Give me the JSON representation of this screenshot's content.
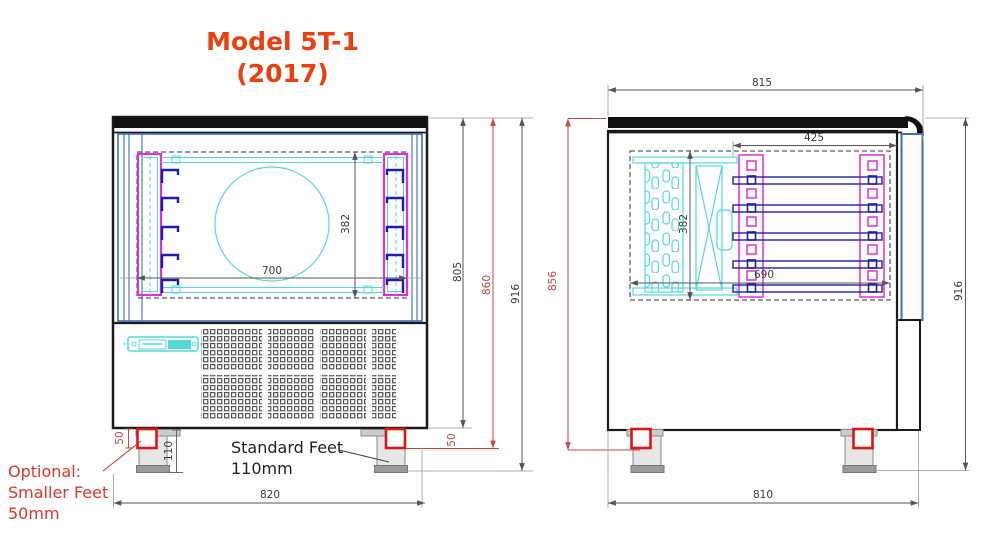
{
  "title": {
    "line1": "Model 5T-1",
    "line2": "(2017)"
  },
  "views": {
    "front": {
      "width_inner": "700",
      "height_inner": "382",
      "height_body": "805",
      "height_small_feet": "860",
      "height_overall": "916",
      "small_foot_left": "50",
      "small_foot_right": "50",
      "standard_foot": "110",
      "width_overall": "820"
    },
    "side": {
      "depth_top": "815",
      "depth_trays": "425",
      "height_inner": "382",
      "depth_inner": "690",
      "height_small_feet": "856",
      "height_overall": "916",
      "depth_overall": "810"
    }
  },
  "annotations": {
    "optional1": "Optional:",
    "optional2": "Smaller Feet",
    "optional3": "50mm",
    "standard1": "Standard Feet",
    "standard2": "110mm"
  },
  "colors": {
    "title": "#e8400f",
    "dimension_red": "#cc4444",
    "foot_red": "#dd1515",
    "cyan": "#55d8d8",
    "magenta": "#e02fd8",
    "navy": "#2020a5",
    "steel_blue": "#4070ad",
    "line_black": "#1a1a1a"
  }
}
